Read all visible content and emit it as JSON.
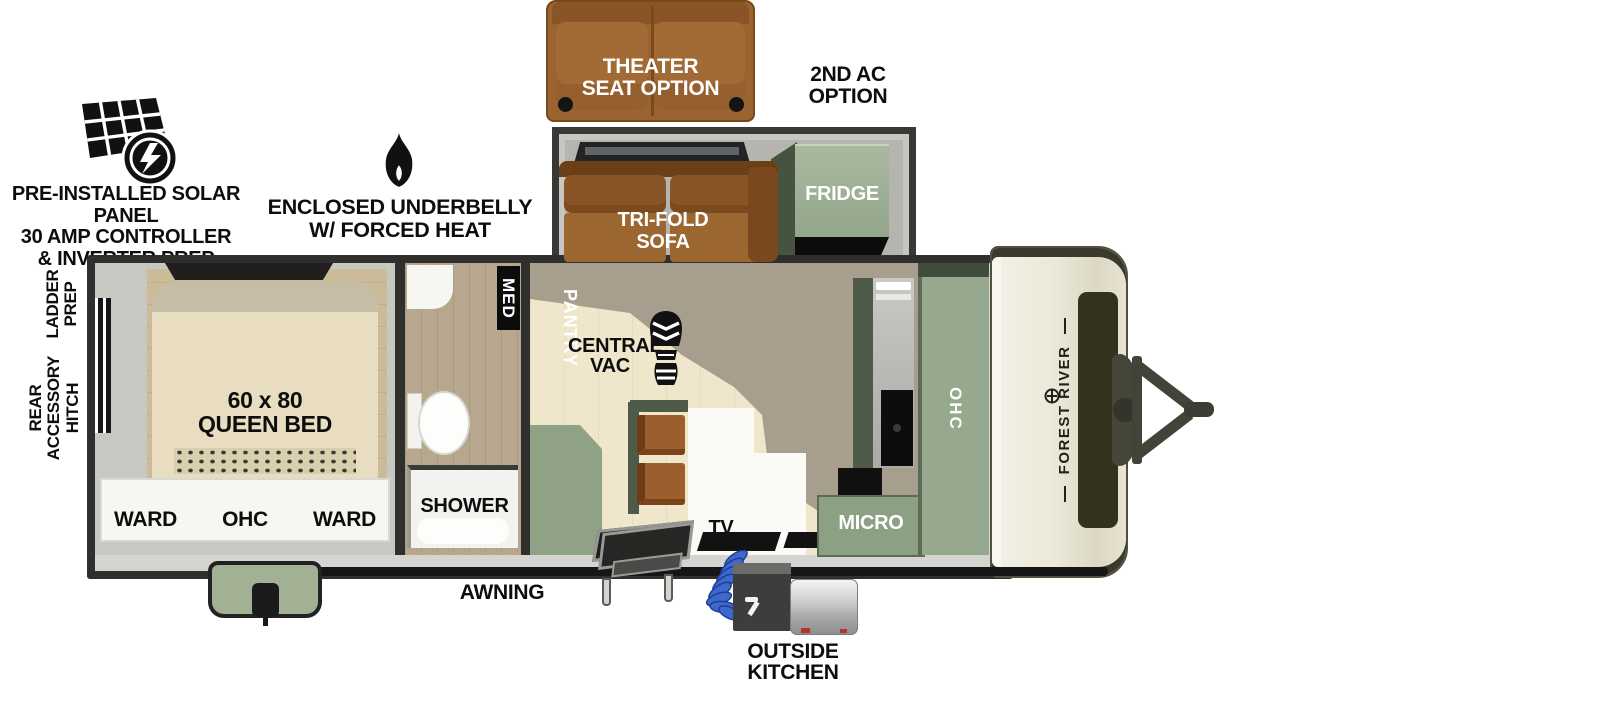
{
  "diagram": {
    "type": "rv-floorplan"
  },
  "brand": "FOREST RIVER",
  "callouts": {
    "theater_seat": [
      "THEATER",
      "SEAT OPTION"
    ],
    "second_ac": [
      "2ND AC",
      "OPTION"
    ],
    "solar": [
      "PRE-INSTALLED SOLAR PANEL",
      "30 AMP CONTROLLER",
      "& INVERTER PREP"
    ],
    "underbelly": [
      "ENCLOSED UNDERBELLY",
      "W/ FORCED HEAT"
    ],
    "ladder": [
      "LADDER",
      "PREP"
    ],
    "rear_hitch": [
      "REAR",
      "ACCESSORY",
      "HITCH"
    ],
    "awning": "AWNING",
    "outside_kitchen": [
      "OUTSIDE",
      "KITCHEN"
    ]
  },
  "slideout": {
    "sofa": [
      "TRI-FOLD",
      "SOFA"
    ],
    "fridge": "FRIDGE"
  },
  "bedroom": {
    "bed": [
      "60 x 80",
      "QUEEN BED"
    ],
    "wardrobe": [
      "WARD",
      "OHC",
      "WARD"
    ]
  },
  "bathroom": {
    "med": "MED",
    "shower": "SHOWER"
  },
  "kitchen": {
    "central_vac": [
      "CENTRAL",
      "VAC"
    ],
    "pantry": "PANTRY",
    "tv": "TV",
    "micro": "MICRO",
    "ohc": "OHC"
  },
  "icons": {
    "solar": "solar-panel-icon",
    "heat": "flame-icon",
    "central_vac": "bootprint-icon",
    "brand": "forest-river-logo-icon"
  },
  "colors": {
    "cabinet_sage": "#96a98e",
    "cabinet_dark": "#4d5b48",
    "sofa_brown": "#91602f",
    "floor_cream": "#efe6cc",
    "floor_taupe": "#a89e8e",
    "wall": "#2f2f2d",
    "front_cap_cream": "#ebe8d8",
    "hose_blue": "#3a63c8",
    "awning": "#161616"
  }
}
